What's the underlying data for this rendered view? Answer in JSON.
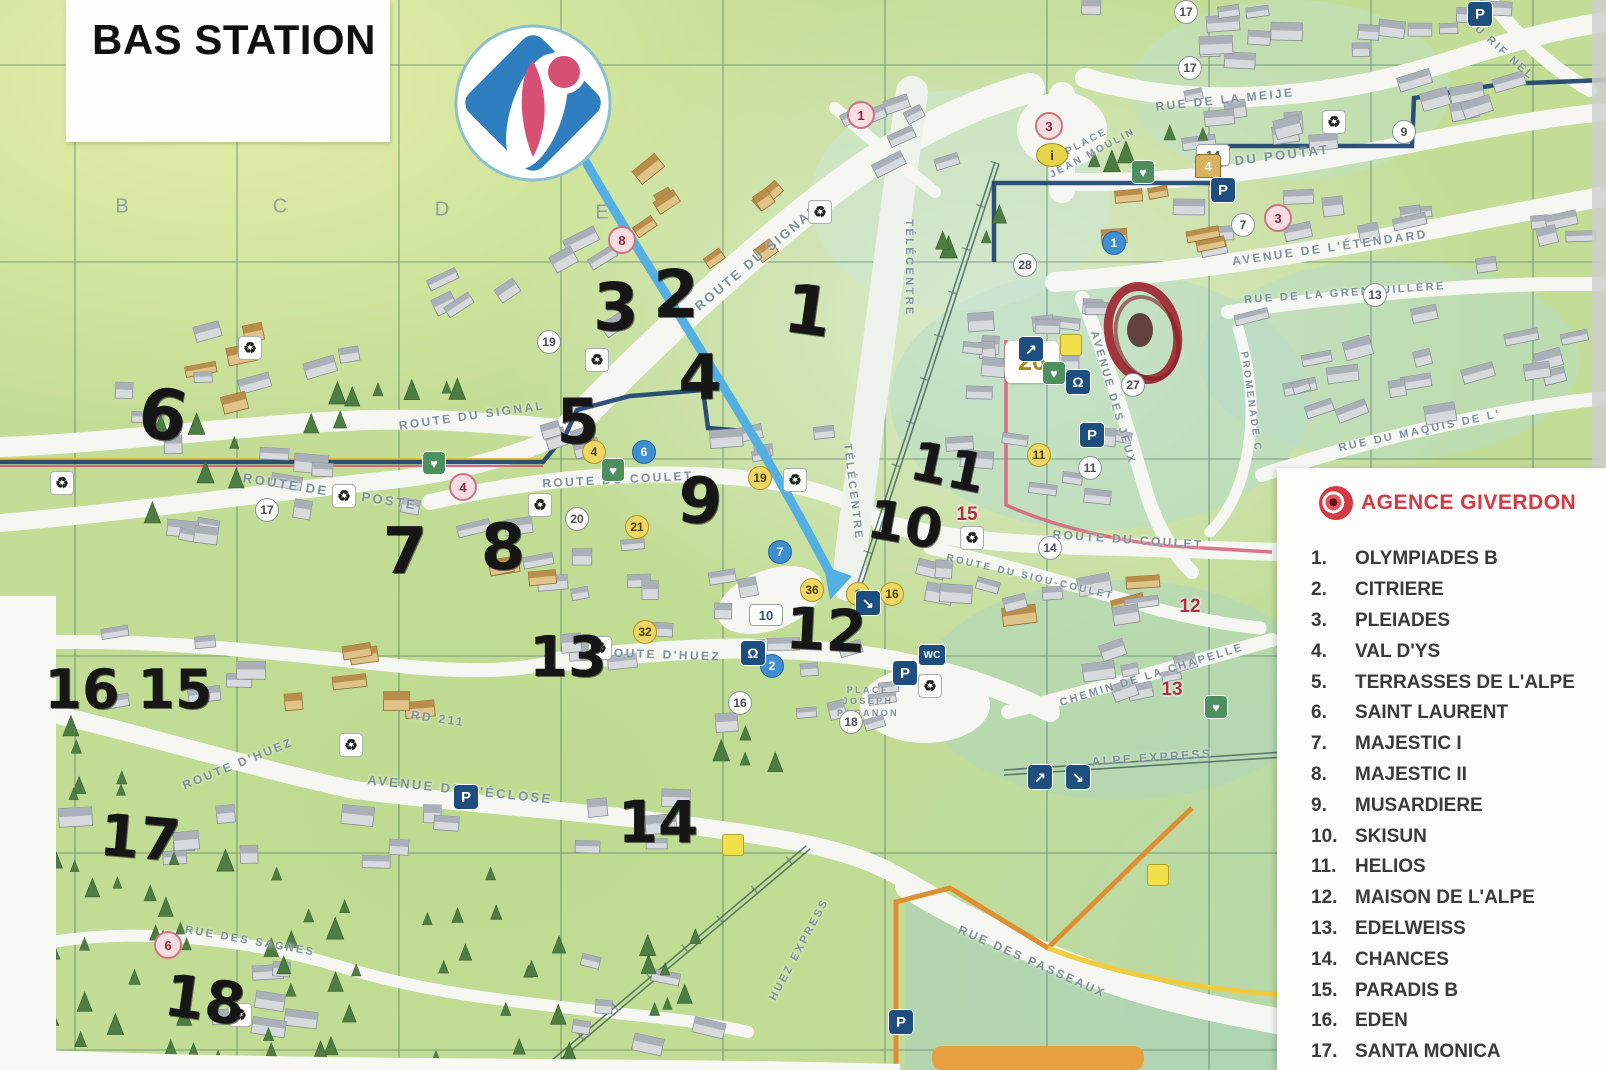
{
  "title": "BAS STATION",
  "legend": {
    "title": "AGENCE GIVERDON",
    "items": [
      {
        "num": "1.",
        "name": "OLYMPIADES B"
      },
      {
        "num": "2.",
        "name": "CITRIERE"
      },
      {
        "num": "3.",
        "name": "PLEIADES"
      },
      {
        "num": "4.",
        "name": "VAL D'YS"
      },
      {
        "num": "5.",
        "name": "TERRASSES DE L'ALPE"
      },
      {
        "num": "6.",
        "name": "SAINT LAURENT"
      },
      {
        "num": "7.",
        "name": "MAJESTIC I"
      },
      {
        "num": "8.",
        "name": "MAJESTIC II"
      },
      {
        "num": "9.",
        "name": "MUSARDIERE"
      },
      {
        "num": "10.",
        "name": "SKISUN"
      },
      {
        "num": "11.",
        "name": "HELIOS"
      },
      {
        "num": "12.",
        "name": "MAISON DE L'ALPE"
      },
      {
        "num": "13.",
        "name": "EDELWEISS"
      },
      {
        "num": "14.",
        "name": "CHANCES"
      },
      {
        "num": "15.",
        "name": "PARADIS B"
      },
      {
        "num": "16.",
        "name": "EDEN"
      },
      {
        "num": "17.",
        "name": "SANTA MONICA"
      }
    ]
  },
  "map": {
    "grid_letters": [
      {
        "t": "B",
        "x": 122,
        "y": 207
      },
      {
        "t": "C",
        "x": 280,
        "y": 207
      },
      {
        "t": "D",
        "x": 442,
        "y": 210
      },
      {
        "t": "E",
        "x": 602,
        "y": 213
      }
    ],
    "streets": [
      {
        "t": "ROUTE DU SIGNAL",
        "x": 757,
        "y": 258,
        "r": -40,
        "s": 13
      },
      {
        "t": "ROUTE DU SIGNAL",
        "x": 472,
        "y": 416,
        "r": -8,
        "s": 12
      },
      {
        "t": "ROUTE DE LA POSTE",
        "x": 330,
        "y": 492,
        "r": 9,
        "s": 13
      },
      {
        "t": "ROUTE DU COULET",
        "x": 618,
        "y": 480,
        "r": -3,
        "s": 12
      },
      {
        "t": "ROUTE DU COULET",
        "x": 1128,
        "y": 540,
        "r": 4,
        "s": 12
      },
      {
        "t": "ROUTE DU SIOU-COULET",
        "x": 1030,
        "y": 578,
        "r": 13,
        "s": 10
      },
      {
        "t": "TÉLÉCENTRE",
        "x": 908,
        "y": 268,
        "r": 90,
        "s": 11
      },
      {
        "t": "TÉLÉCENTRE",
        "x": 852,
        "y": 492,
        "r": 83,
        "s": 11
      },
      {
        "t": "RUE DE LA MEIJE",
        "x": 1225,
        "y": 100,
        "r": -6,
        "s": 12
      },
      {
        "t": "RUE DU POUTAT",
        "x": 1262,
        "y": 158,
        "r": -7,
        "s": 13
      },
      {
        "t": "DU RIF NEL",
        "x": 1500,
        "y": 50,
        "r": 42,
        "s": 11
      },
      {
        "t": "AVENUE DE L'ÉTENDARD",
        "x": 1330,
        "y": 248,
        "r": -8,
        "s": 12
      },
      {
        "t": "RUE DE LA GRENOUILLÈRE",
        "x": 1345,
        "y": 294,
        "r": -4,
        "s": 11
      },
      {
        "t": "PROMENADE C",
        "x": 1250,
        "y": 402,
        "r": 82,
        "s": 10
      },
      {
        "t": "RUE DU MAQUIS DE L'",
        "x": 1420,
        "y": 432,
        "r": -12,
        "s": 11
      },
      {
        "t": "AVENUE DES JEUX",
        "x": 1112,
        "y": 398,
        "r": 74,
        "s": 11
      },
      {
        "t": "PLACE|JEAN MOULIN",
        "x": 1090,
        "y": 148,
        "r": -28,
        "s": 10
      },
      {
        "t": "CHEMIN DE LA CHAPELLE",
        "x": 1152,
        "y": 676,
        "r": -17,
        "s": 11
      },
      {
        "t": "ROUTE D'HUEZ",
        "x": 662,
        "y": 655,
        "r": 2,
        "s": 12
      },
      {
        "t": "ROUTE D'HUEZ",
        "x": 238,
        "y": 764,
        "r": -22,
        "s": 12
      },
      {
        "t": "RD 211",
        "x": 438,
        "y": 719,
        "r": 8,
        "s": 12
      },
      {
        "t": "AVENUE DE L'ÉCLOSE",
        "x": 460,
        "y": 790,
        "r": 6,
        "s": 13
      },
      {
        "t": "PLACE|JOSEPH|PAGANON",
        "x": 868,
        "y": 702,
        "r": 0,
        "s": 9
      },
      {
        "t": "ALPE EXPRESS",
        "x": 1152,
        "y": 758,
        "r": -4,
        "s": 12
      },
      {
        "t": "HUEZ EXPRESS",
        "x": 800,
        "y": 950,
        "r": -62,
        "s": 11
      },
      {
        "t": "RUE DES SAGNES",
        "x": 250,
        "y": 942,
        "r": 10,
        "s": 11
      },
      {
        "t": "RUE DES PASSEAUX",
        "x": 1032,
        "y": 962,
        "r": 24,
        "s": 12
      }
    ],
    "handwritten_numbers": [
      {
        "t": "1",
        "x": 808,
        "y": 312,
        "s": 68,
        "r": 8
      },
      {
        "t": "2",
        "x": 676,
        "y": 295,
        "s": 66,
        "r": 0
      },
      {
        "t": "3",
        "x": 616,
        "y": 308,
        "s": 66,
        "r": 0
      },
      {
        "t": "4",
        "x": 700,
        "y": 378,
        "s": 62,
        "r": 0
      },
      {
        "t": "5",
        "x": 578,
        "y": 422,
        "s": 62,
        "r": 0
      },
      {
        "t": "6",
        "x": 163,
        "y": 415,
        "s": 70,
        "r": 10
      },
      {
        "t": "7",
        "x": 405,
        "y": 552,
        "s": 64,
        "r": 0
      },
      {
        "t": "8",
        "x": 503,
        "y": 548,
        "s": 64,
        "r": 0
      },
      {
        "t": "9",
        "x": 700,
        "y": 502,
        "s": 64,
        "r": 5
      },
      {
        "t": "10",
        "x": 905,
        "y": 525,
        "s": 54,
        "r": 10
      },
      {
        "t": "11",
        "x": 948,
        "y": 468,
        "s": 54,
        "r": 12
      },
      {
        "t": "12",
        "x": 826,
        "y": 630,
        "s": 58,
        "r": 3
      },
      {
        "t": "13",
        "x": 568,
        "y": 658,
        "s": 56,
        "r": 0
      },
      {
        "t": "14",
        "x": 658,
        "y": 822,
        "s": 58,
        "r": 0
      },
      {
        "t": "15",
        "x": 175,
        "y": 690,
        "s": 54,
        "r": 0
      },
      {
        "t": "16",
        "x": 82,
        "y": 690,
        "s": 54,
        "r": 0
      },
      {
        "t": "17",
        "x": 140,
        "y": 838,
        "s": 58,
        "r": 5
      },
      {
        "t": "18",
        "x": 205,
        "y": 1000,
        "s": 58,
        "r": 8
      }
    ],
    "badges": [
      {
        "t": "4",
        "x": 594,
        "y": 452,
        "c": "yellow"
      },
      {
        "t": "21",
        "x": 637,
        "y": 527,
        "c": "yellow"
      },
      {
        "t": "19",
        "x": 760,
        "y": 478,
        "c": "yellow"
      },
      {
        "t": "36",
        "x": 812,
        "y": 590,
        "c": "yellow"
      },
      {
        "t": "1",
        "x": 858,
        "y": 594,
        "c": "yellow"
      },
      {
        "t": "16",
        "x": 892,
        "y": 594,
        "c": "yellow"
      },
      {
        "t": "32",
        "x": 645,
        "y": 632,
        "c": "yellow"
      },
      {
        "t": "11",
        "x": 1039,
        "y": 455,
        "c": "yellow"
      },
      {
        "t": "19",
        "x": 549,
        "y": 342,
        "c": "white"
      },
      {
        "t": "17",
        "x": 267,
        "y": 510,
        "c": "white"
      },
      {
        "t": "20",
        "x": 577,
        "y": 519,
        "c": "white"
      },
      {
        "t": "11",
        "x": 1090,
        "y": 468,
        "c": "white"
      },
      {
        "t": "14",
        "x": 1050,
        "y": 548,
        "c": "white"
      },
      {
        "t": "16",
        "x": 740,
        "y": 703,
        "c": "white"
      },
      {
        "t": "18",
        "x": 851,
        "y": 722,
        "c": "white"
      },
      {
        "t": "27",
        "x": 1133,
        "y": 385,
        "c": "white"
      },
      {
        "t": "28",
        "x": 1025,
        "y": 265,
        "c": "white"
      },
      {
        "t": "13",
        "x": 1375,
        "y": 295,
        "c": "white"
      },
      {
        "t": "7",
        "x": 1243,
        "y": 225,
        "c": "white"
      },
      {
        "t": "17",
        "x": 1186,
        "y": 12,
        "c": "white"
      },
      {
        "t": "17",
        "x": 1190,
        "y": 68,
        "c": "white"
      },
      {
        "t": "9",
        "x": 1404,
        "y": 132,
        "c": "white"
      },
      {
        "t": "1",
        "x": 861,
        "y": 115,
        "c": "pink"
      },
      {
        "t": "8",
        "x": 622,
        "y": 240,
        "c": "pink"
      },
      {
        "t": "3",
        "x": 1049,
        "y": 126,
        "c": "pink"
      },
      {
        "t": "3",
        "x": 1278,
        "y": 218,
        "c": "pink"
      },
      {
        "t": "4",
        "x": 463,
        "y": 487,
        "c": "pink"
      },
      {
        "t": "6",
        "x": 168,
        "y": 945,
        "c": "pink"
      },
      {
        "t": "6",
        "x": 644,
        "y": 452,
        "c": "blue"
      },
      {
        "t": "7",
        "x": 780,
        "y": 552,
        "c": "blue"
      },
      {
        "t": "2",
        "x": 772,
        "y": 666,
        "c": "blue"
      },
      {
        "t": "1",
        "x": 1114,
        "y": 243,
        "c": "blue"
      },
      {
        "t": "15",
        "x": 967,
        "y": 515,
        "c": "red"
      },
      {
        "t": "12",
        "x": 1190,
        "y": 607,
        "c": "red"
      },
      {
        "t": "13",
        "x": 1172,
        "y": 690,
        "c": "red"
      },
      {
        "t": "10",
        "x": 766,
        "y": 615,
        "c": "box"
      },
      {
        "t": "14",
        "x": 1213,
        "y": 155,
        "c": "box"
      },
      {
        "t": "26",
        "x": 1032,
        "y": 362,
        "c": "bigbox"
      },
      {
        "t": "4",
        "x": 1208,
        "y": 166,
        "c": "tan"
      }
    ],
    "icons": [
      {
        "t": "recycle",
        "g": "♻",
        "x": 250,
        "y": 348
      },
      {
        "t": "recycle",
        "g": "♻",
        "x": 597,
        "y": 360
      },
      {
        "t": "recycle",
        "g": "♻",
        "x": 820,
        "y": 212
      },
      {
        "t": "recycle",
        "g": "♻",
        "x": 1334,
        "y": 122
      },
      {
        "t": "recycle",
        "g": "♻",
        "x": 344,
        "y": 496
      },
      {
        "t": "recycle",
        "g": "♻",
        "x": 540,
        "y": 505
      },
      {
        "t": "recycle",
        "g": "♻",
        "x": 795,
        "y": 480
      },
      {
        "t": "recycle",
        "g": "♻",
        "x": 972,
        "y": 538
      },
      {
        "t": "recycle",
        "g": "♻",
        "x": 600,
        "y": 648
      },
      {
        "t": "recycle",
        "g": "♻",
        "x": 62,
        "y": 483
      },
      {
        "t": "recycle",
        "g": "♻",
        "x": 351,
        "y": 745
      },
      {
        "t": "recycle",
        "g": "♻",
        "x": 1325,
        "y": 655
      },
      {
        "t": "recycle",
        "g": "♻",
        "x": 240,
        "y": 1015
      },
      {
        "t": "recycle",
        "g": "♻",
        "x": 930,
        "y": 686
      },
      {
        "t": "park",
        "g": "P",
        "x": 1480,
        "y": 14
      },
      {
        "t": "park",
        "g": "P",
        "x": 1223,
        "y": 190
      },
      {
        "t": "park",
        "g": "P",
        "x": 1092,
        "y": 435
      },
      {
        "t": "park",
        "g": "P",
        "x": 466,
        "y": 797
      },
      {
        "t": "park",
        "g": "P",
        "x": 905,
        "y": 673
      },
      {
        "t": "park",
        "g": "P",
        "x": 901,
        "y": 1022
      },
      {
        "t": "wc",
        "g": "WC",
        "x": 932,
        "y": 655
      },
      {
        "t": "plug",
        "g": "Ω",
        "x": 1078,
        "y": 382
      },
      {
        "t": "plug",
        "g": "Ω",
        "x": 753,
        "y": 653
      },
      {
        "t": "heart",
        "g": "♥",
        "x": 1143,
        "y": 172
      },
      {
        "t": "heart",
        "g": "♥",
        "x": 434,
        "y": 463
      },
      {
        "t": "heart",
        "g": "♥",
        "x": 613,
        "y": 470
      },
      {
        "t": "heart",
        "g": "♥",
        "x": 1216,
        "y": 707
      },
      {
        "t": "heart",
        "g": "♥",
        "x": 1054,
        "y": 373
      },
      {
        "t": "lift",
        "g": "↗",
        "x": 1031,
        "y": 349
      },
      {
        "t": "lift",
        "g": "↘",
        "x": 868,
        "y": 603
      },
      {
        "t": "lift",
        "g": "↗",
        "x": 1040,
        "y": 777
      },
      {
        "t": "lift",
        "g": "↘",
        "x": 1078,
        "y": 777
      },
      {
        "t": "lift",
        "g": "↗",
        "x": 1294,
        "y": 556
      },
      {
        "t": "info",
        "g": "i",
        "x": 1052,
        "y": 155
      },
      {
        "t": "ysq",
        "g": "",
        "x": 1071,
        "y": 345
      },
      {
        "t": "ysq",
        "g": "",
        "x": 1158,
        "y": 875
      },
      {
        "t": "ysq",
        "g": "",
        "x": 733,
        "y": 845
      }
    ],
    "colors": {
      "marker_red": "#9e2430",
      "legend_red": "#d23b45",
      "route_navy": "#1a3f6e",
      "pointer_blue": "#55b0e2",
      "logo_blue": "#2e7ec0",
      "logo_pink": "#d64f74"
    }
  }
}
